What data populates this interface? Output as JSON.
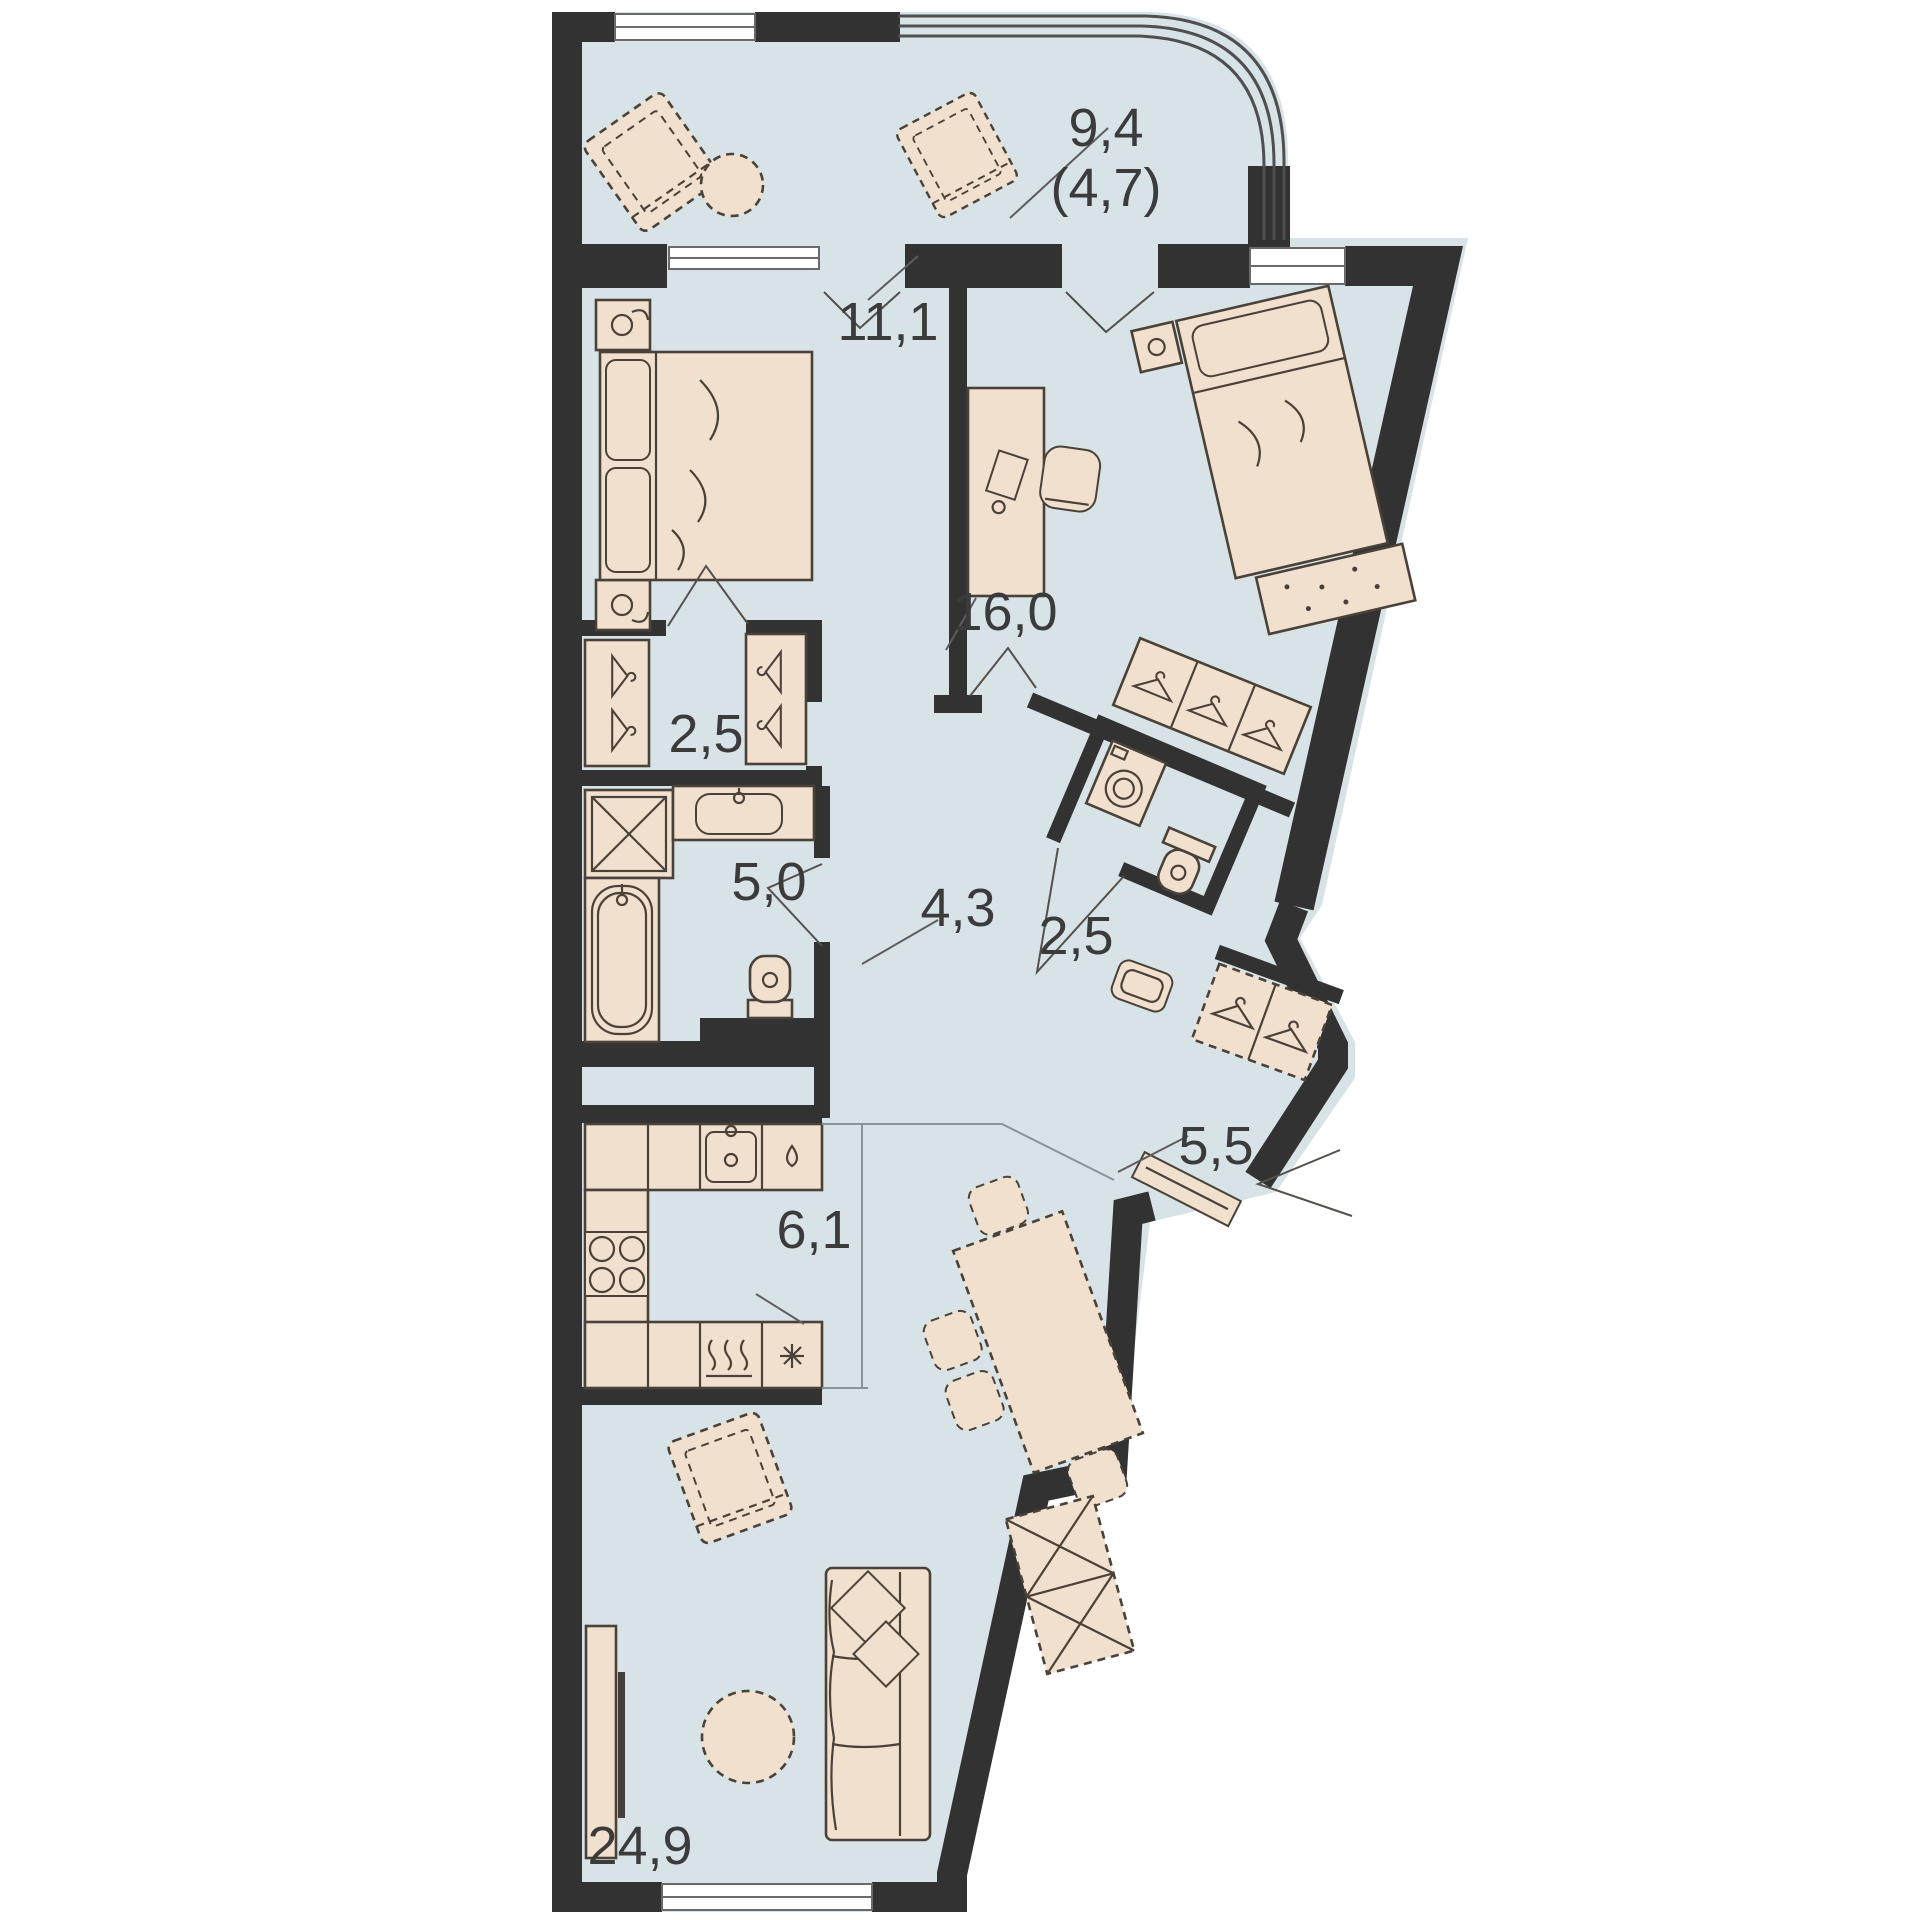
{
  "plan": {
    "title": "apartment-floor-plan",
    "rooms": [
      {
        "name": "balcony",
        "area": "9,4",
        "area_secondary": "(4,7)"
      },
      {
        "name": "bedroom-1",
        "area": "11,1"
      },
      {
        "name": "bedroom-2",
        "area": "16,0"
      },
      {
        "name": "walk-in-closet",
        "area": "2,5"
      },
      {
        "name": "bathroom",
        "area": "5,0"
      },
      {
        "name": "hallway",
        "area": "4,3"
      },
      {
        "name": "wc-laundry",
        "area": "2,5"
      },
      {
        "name": "entrance-hall",
        "area": "5,5"
      },
      {
        "name": "kitchen",
        "area": "6,1"
      },
      {
        "name": "living-room",
        "area": "24,9"
      }
    ],
    "colors": {
      "background": "#ffffff",
      "floor": "#d8e3e7",
      "wall": "#323232",
      "furniture": "#f1e0cd",
      "furniture_outline": "#4a4238",
      "label": "#3b3b3b"
    }
  }
}
